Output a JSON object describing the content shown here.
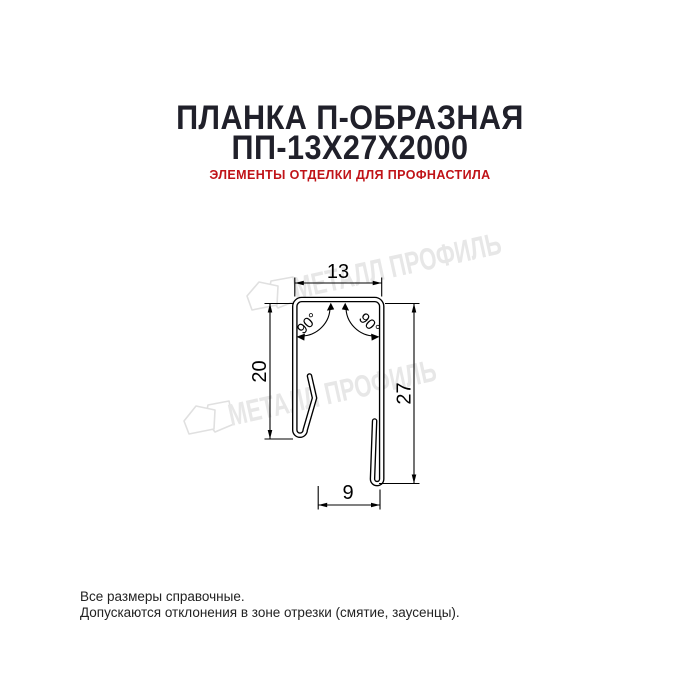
{
  "title": {
    "line1": "ПЛАНКА П-ОБРАЗНАЯ",
    "line2": "ПП-13Х27Х2000"
  },
  "subtitle": "ЭЛЕМЕНТЫ ОТДЕЛКИ ДЛЯ ПРОФНАСТИЛА",
  "diagram": {
    "dim_top": "13",
    "dim_left": "20",
    "dim_right": "27",
    "dim_bottom": "9",
    "angle_left": "90°",
    "angle_right": "90°"
  },
  "watermark": {
    "text": "МЕТАЛЛ ПРОФИЛЬ",
    "color": "#e7e7e7"
  },
  "footer": {
    "line1": "Все размеры справочные.",
    "line2": "Допускаются отклонения в зоне отрезки (смятие, заусенцы)."
  },
  "colors": {
    "background": "#ffffff",
    "title": "#20202a",
    "subtitle": "#c01318",
    "line": "#000000",
    "watermark": "#e7e7e7"
  }
}
